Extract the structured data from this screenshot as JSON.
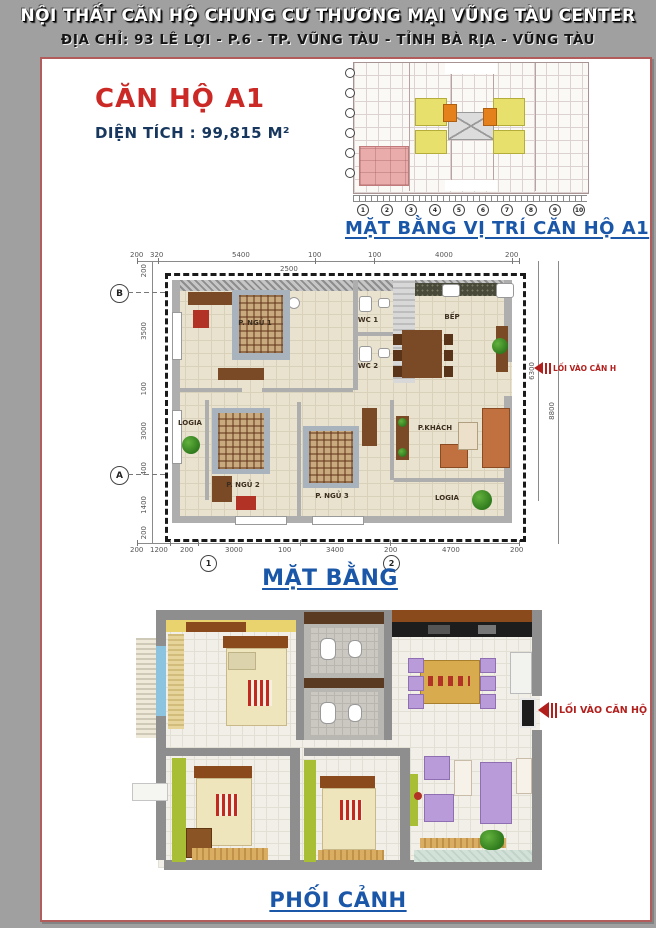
{
  "header": {
    "title": "NỘI THẤT CĂN HỘ CHUNG CƯ THƯƠNG MẠI VŨNG TÀU CENTER",
    "address": "ĐỊA CHỈ: 93 LÊ LỢI - P.6 - TP. VŨNG TÀU - TỈNH BÀ RỊA - VŨNG TÀU"
  },
  "apartment": {
    "name": "CĂN HỘ A1",
    "area_label": "DIỆN TÍCH : 99,815 M²"
  },
  "location_plan": {
    "caption": "MẶT BẰNG VỊ TRÍ CĂN HỘ A1",
    "column_labels": [
      "1",
      "2",
      "3",
      "4",
      "5",
      "6",
      "7",
      "8",
      "9",
      "10"
    ]
  },
  "floor_plan": {
    "caption": "MẶT BẰNG",
    "entrance_label": "LỐI VÀO CĂN H",
    "rooms": {
      "bedroom1": "P. NGỦ 1",
      "bedroom2": "P. NGỦ 2",
      "bedroom3": "P. NGỦ 3",
      "wc1": "WC 1",
      "wc2": "WC 2",
      "kitchen": "BẾP",
      "living": "P.KHÁCH",
      "logia_left": "LOGIA",
      "logia_right": "LOGIA"
    },
    "grid": {
      "row_top": "B",
      "row_bottom": "A",
      "col_left": "1",
      "col_right": "2"
    },
    "dims": {
      "top": [
        "200",
        "320",
        "5400",
        "100",
        "2500",
        "100",
        "4000",
        "200"
      ],
      "bottom": [
        "200",
        "1200",
        "200",
        "3000",
        "100",
        "3400",
        "200",
        "4700",
        "200"
      ],
      "left": [
        "200",
        "3500",
        "100",
        "3000",
        "400",
        "1400",
        "200"
      ],
      "right": [
        "6300",
        "8800"
      ]
    }
  },
  "perspective": {
    "caption": "PHỐI CẢNH",
    "entrance_label": "LỐI VÀO CĂN HỘ"
  },
  "colors": {
    "page_bg": "#a0a0a0",
    "panel_border": "#b25c5c",
    "heading_red": "#cb2926",
    "navy_blue": "#17375e",
    "caption_blue": "#1b57a8",
    "entrance_red": "#b2201d",
    "unit_highlight_pink": "#eaabab",
    "unit_yellow": "#e7e06c",
    "unit_orange": "#e5811c"
  }
}
